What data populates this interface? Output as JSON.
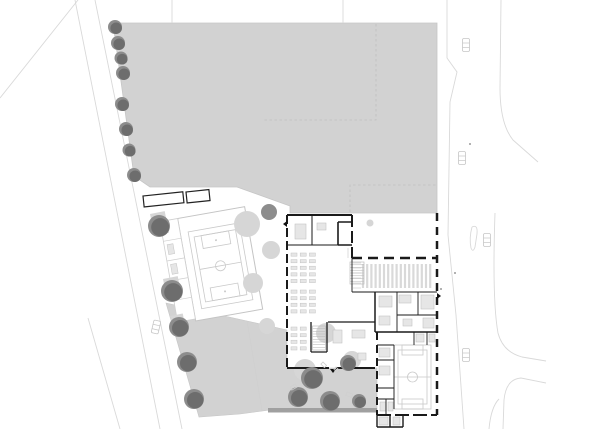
{
  "page": {
    "title": "Architectural site plan with school building, gymnasium, sports field, courtyard and adjacent streets",
    "visible_text": []
  },
  "colors": {
    "paper": "#ffffff",
    "surface_gray": "#d2d2d2",
    "surface_edge": "#c6c6c6",
    "canopy": "#d6d6d6",
    "tree_back": "#8c8c8c",
    "tree_front": "#6d6d6d",
    "tree_mid": "#8d8d8d",
    "wall": "#1a1a1a",
    "partition": "#4a4a4a",
    "court_line": "#c9c9c9",
    "light_line": "#cfcfcf",
    "road_line": "#d9d9d9",
    "furniture_fill": "#e6e6e6",
    "furniture_stroke": "#c4c4c4",
    "stripe": "#d9d9d9",
    "band": "#a0a0a0",
    "dashed_marking": "#c0c0c0"
  },
  "site": {
    "field_polygon": "113,23 437,23 437,213 290,213 290,206 237,187 150,187 134,176",
    "field_dashed_markings": [
      "376,24 376,120 262,120",
      "350,212 350,185 437,185"
    ],
    "courtyard_polygon": "166,303 247,321 287,330 287,368 377,368 377,410 270,410 240,414 199,417",
    "courtyard_divider": "M247,321 L262,410",
    "band_polygon": "268,408 377,408 377,412.5 268,412.5",
    "trees_dark": [
      [
        115,
        27,
        7
      ],
      [
        118,
        43,
        7
      ],
      [
        121,
        58,
        6.5
      ],
      [
        123,
        73,
        7
      ],
      [
        122,
        104,
        7
      ],
      [
        126,
        129,
        7
      ],
      [
        129,
        150,
        6.5
      ],
      [
        134,
        175,
        7
      ],
      [
        159,
        226,
        11
      ],
      [
        172,
        291,
        11
      ],
      [
        179,
        327,
        10
      ],
      [
        187,
        362,
        10
      ],
      [
        194,
        399,
        10
      ],
      [
        348,
        363,
        8
      ],
      [
        312,
        378,
        11
      ],
      [
        298,
        397,
        10
      ],
      [
        330,
        401,
        10
      ],
      [
        359,
        401,
        7
      ]
    ],
    "trees_mid": [
      [
        269,
        212,
        8
      ]
    ],
    "canopies": [
      [
        247,
        224,
        13
      ],
      [
        271,
        250,
        9
      ],
      [
        253,
        283,
        10
      ],
      [
        370,
        223,
        3.5
      ],
      [
        267,
        326,
        8
      ],
      [
        326,
        333,
        10
      ],
      [
        352,
        360,
        9
      ],
      [
        305,
        370,
        11
      ]
    ],
    "tree_pads": [
      {
        "x": 150,
        "y": 214,
        "w": 15,
        "h": 22,
        "r": -11
      },
      {
        "x": 163,
        "y": 279,
        "w": 15,
        "h": 22,
        "r": -11
      },
      {
        "x": 170,
        "y": 316,
        "w": 13,
        "h": 19,
        "r": -11
      }
    ],
    "benches": [
      {
        "x": 323,
        "y": 362,
        "s": 5,
        "r": 45
      },
      {
        "x": 336,
        "y": 367,
        "s": 5,
        "r": 45
      },
      {
        "x": 347,
        "y": 392,
        "s": 6,
        "r": 20
      },
      {
        "x": 290,
        "y": 387,
        "s": 6,
        "r": -30
      }
    ],
    "parking_shelters": [
      {
        "x": 143,
        "y": 196,
        "w": 40,
        "h": 11,
        "r": -6
      },
      {
        "x": 186,
        "y": 192,
        "w": 23,
        "h": 11,
        "r": -6
      }
    ],
    "cars": [
      {
        "x": 466,
        "y": 45,
        "r": 0
      },
      {
        "x": 462,
        "y": 158,
        "r": 0
      },
      {
        "x": 487,
        "y": 240,
        "r": 0
      },
      {
        "x": 466,
        "y": 355,
        "r": 0
      },
      {
        "x": 156,
        "y": 327,
        "r": 13
      }
    ],
    "dots": [
      [
        455,
        273
      ],
      [
        441,
        289
      ],
      [
        470,
        144
      ]
    ],
    "roads": {
      "left_lines": [
        [
          75,
          0,
          160,
          429
        ],
        [
          95,
          0,
          182,
          429
        ],
        [
          88,
          318,
          120,
          429
        ],
        [
          78,
          0,
          0,
          98
        ]
      ],
      "top_stubs": [
        [
          172,
          0,
          172,
          23
        ],
        [
          343,
          0,
          343,
          23
        ]
      ],
      "right_paths": [
        "M447,0 L447,58 L457,72 L450,102 L448,235 L456,315 L464,429",
        "M501,0 L500,88 Q500,124 513,140 L538,162",
        "M495,213 Q492,300 498,333 Q503,352 522,357 L546,361",
        "M546,383 L521,378 Q506,379 504,400 L503,429",
        "M489,429 Q491,407 499,399"
      ],
      "island_path": "M472,227 Q478,224 477,234 L475,247 Q473,253 471,248 Q469,238 472,227"
    }
  },
  "gym": {
    "rotation": [
      -10,
      219,
      263
    ],
    "building_rect": {
      "x": 186,
      "y": 212,
      "w": 68,
      "h": 104
    },
    "court_outer": {
      "x": 194,
      "y": 227,
      "w": 52,
      "h": 78
    },
    "court_inner": {
      "x": 199,
      "y": 233,
      "w": 42,
      "h": 66
    },
    "mid_line": "M199,266 H241",
    "center_circle": [
      220,
      266,
      5
    ],
    "key_top": {
      "x": 206,
      "y": 233,
      "w": 28,
      "h": 13
    },
    "key_bottom": {
      "x": 206,
      "y": 286,
      "w": 28,
      "h": 13
    },
    "spots": [
      [
        220,
        240
      ],
      [
        220,
        292
      ]
    ],
    "strip_rect": {
      "x": 168,
      "y": 212,
      "w": 18,
      "h": 102
    },
    "strip_lines": [
      "M168,232 H186",
      "M168,252 H186",
      "M168,272 H186",
      "M168,292 H186"
    ],
    "strip_fixtures": [
      [
        171,
        236,
        6,
        10
      ],
      [
        171,
        256,
        6,
        10
      ],
      [
        171,
        278,
        6,
        10
      ]
    ]
  },
  "building": {
    "walls": [
      {
        "d": "M287,215 H352",
        "w": 2
      },
      {
        "d": "M287,215 V368",
        "w": 2,
        "dash": "9 4"
      },
      {
        "d": "M287,368 H329",
        "w": 2
      },
      {
        "d": "M336,368 H375",
        "w": 2
      },
      {
        "d": "M352,215 V258",
        "w": 2,
        "dash": "12 4"
      },
      {
        "d": "M352,258 H437",
        "w": 2.5,
        "dash": "10 6"
      },
      {
        "d": "M437,213 V415",
        "w": 2.5,
        "dash": "8 6"
      },
      {
        "d": "M377,332 V415",
        "w": 2,
        "dash": "8 5"
      },
      {
        "d": "M377,415 H437",
        "w": 2,
        "dash": "14 4"
      },
      {
        "d": "M375,292 V332",
        "w": 1.5
      },
      {
        "d": "M375,332 H437",
        "w": 1.5
      },
      {
        "d": "M377,415 V427 M377,427 H403 M403,427 V415 M390,415 V427",
        "w": 1.4
      },
      {
        "d": "M287,245 H352",
        "w": 1
      },
      {
        "d": "M312,215 V245",
        "w": 1
      },
      {
        "d": "M338,222 H352 M338,222 V245 M338,245 H352",
        "w": 1.6
      },
      {
        "d": "M352,258 V292",
        "w": 0.9
      },
      {
        "d": "M352,292 H437",
        "w": 1
      },
      {
        "d": "M397,292 V332 M418,292 V315 M397,315 H437",
        "w": 0.9
      },
      {
        "d": "M394,345 V409 M377,345 H394 M377,360 H394 M377,388 H394 M414,332 V345 M427,332 V345",
        "w": 0.9
      },
      {
        "d": "M377,399 H394 M386,399 V415",
        "w": 0.9
      },
      {
        "d": "M311,322 V352 M311,352 H327 M327,322 V352",
        "w": 1.3
      },
      {
        "d": "M328,322 H375",
        "w": 1.3
      }
    ],
    "thin_lines": [
      "M348,248 V258"
    ],
    "hall_stripes": {
      "x0": 363,
      "x1": 433,
      "step": 4.2,
      "y0": 264,
      "y1": 288
    },
    "hall_hatch": {
      "x": 353,
      "y": 263,
      "w": 8,
      "h": 25,
      "lines": 6
    },
    "desk_groups": [
      {
        "x": 291,
        "y": 253,
        "rows": 5,
        "cols": 3,
        "cw": 6,
        "ch": 3.2,
        "px": 9.2,
        "py": 6.6
      },
      {
        "x": 291,
        "y": 290,
        "rows": 4,
        "cols": 3,
        "cw": 6,
        "ch": 3.2,
        "px": 9.2,
        "py": 6.6
      },
      {
        "x": 291,
        "y": 327,
        "rows": 4,
        "cols": 2,
        "cw": 6,
        "ch": 3.2,
        "px": 9.2,
        "py": 6.6
      }
    ],
    "fixtures": [
      [
        295,
        224,
        11,
        15
      ],
      [
        317,
        223,
        9,
        7
      ],
      [
        333,
        330,
        9,
        13
      ],
      [
        352,
        330,
        13,
        8
      ],
      [
        358,
        353,
        8,
        7
      ],
      [
        379,
        296,
        13,
        11
      ],
      [
        399,
        295,
        12,
        8
      ],
      [
        421,
        295,
        13,
        14
      ],
      [
        379,
        316,
        11,
        9
      ],
      [
        403,
        319,
        9,
        7
      ],
      [
        423,
        318,
        11,
        10
      ],
      [
        379,
        348,
        11,
        9
      ],
      [
        379,
        366,
        11,
        9
      ],
      [
        380,
        402,
        6,
        9
      ],
      [
        388,
        402,
        5,
        9
      ],
      [
        379,
        417,
        9,
        8
      ],
      [
        393,
        417,
        7,
        8
      ],
      [
        416,
        334,
        8,
        8
      ],
      [
        429,
        334,
        6,
        8
      ]
    ],
    "stairs": [
      {
        "x": 350,
        "y": 262,
        "w": 14,
        "h": 22,
        "treads": 8
      },
      {
        "x": 312.5,
        "y": 326,
        "w": 13,
        "h": 24,
        "treads": 9
      }
    ],
    "small_court": {
      "outer": {
        "x": 394,
        "y": 345,
        "w": 37,
        "h": 64
      },
      "inner": {
        "x": 398,
        "y": 350,
        "w": 29,
        "h": 54
      },
      "mid": "M394,377 H431",
      "circle": [
        412.5,
        377,
        5
      ],
      "key_top": {
        "x": 402,
        "y": 345,
        "w": 21,
        "h": 10
      },
      "key_bottom": {
        "x": 402,
        "y": 399,
        "w": 21,
        "h": 10
      }
    },
    "door_markers": [
      {
        "points": "330,369 336,369 333,373"
      },
      {
        "points": "287,221 287,227 283,224"
      },
      {
        "points": "437,293 437,299 441,296"
      }
    ]
  }
}
